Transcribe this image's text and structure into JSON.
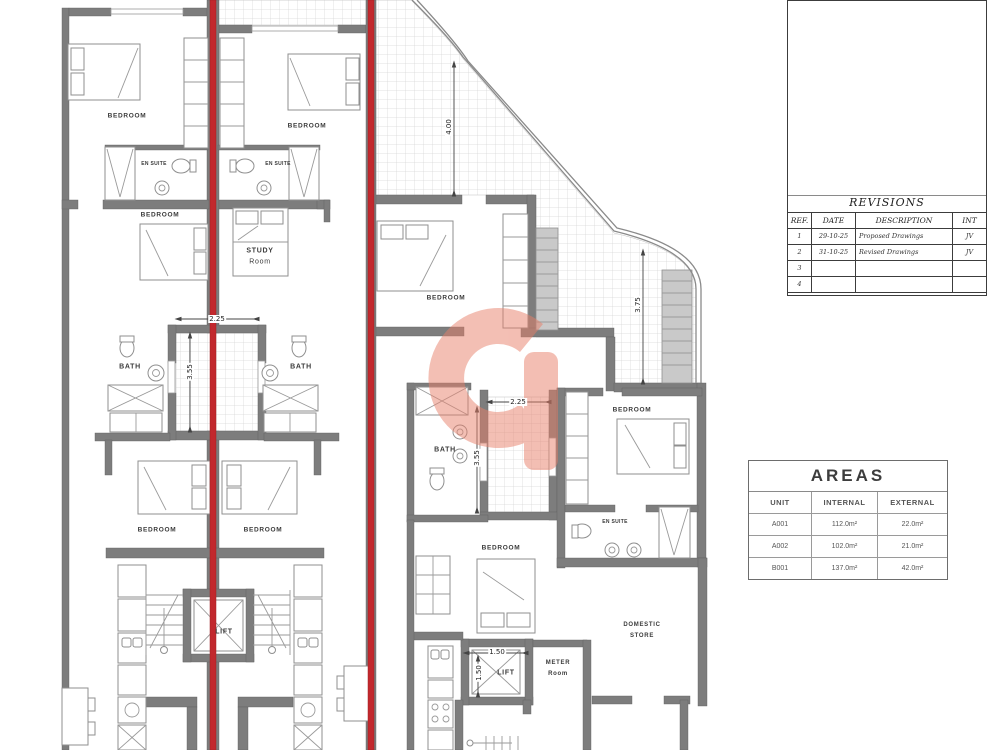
{
  "title_block": {
    "revisions": {
      "title": "REVISIONS",
      "headers": {
        "ref": "REF.",
        "date": "DATE",
        "description": "DESCRIPTION",
        "int": "INT"
      },
      "rows": [
        {
          "ref": "1",
          "date": "29-10-25",
          "description": "Proposed Drawings",
          "int": "JV"
        },
        {
          "ref": "2",
          "date": "31-10-25",
          "description": "Revised Drawings",
          "int": "JV"
        },
        {
          "ref": "3",
          "date": "",
          "description": "",
          "int": ""
        },
        {
          "ref": "4",
          "date": "",
          "description": "",
          "int": ""
        }
      ]
    }
  },
  "areas": {
    "title": "AREAS",
    "headers": {
      "unit": "UNIT",
      "internal": "INTERNAL",
      "external": "EXTERNAL"
    },
    "rows": [
      {
        "unit": "A001",
        "internal": "112.0m²",
        "external": "22.0m²"
      },
      {
        "unit": "A002",
        "internal": "102.0m²",
        "external": "21.0m²"
      },
      {
        "unit": "B001",
        "internal": "137.0m²",
        "external": "42.0m²"
      }
    ]
  },
  "labels": {
    "bedroom": "BEDROOM",
    "en_suite": "EN SUITE",
    "study_line1": "STUDY",
    "study_line2": "Room",
    "bath": "BATH",
    "lift": "LIFT",
    "meter_line1": "METER",
    "meter_line2": "Room",
    "domestic_line1": "DOMESTIC",
    "domestic_line2": "STORE"
  },
  "dimensions": {
    "terrace_front": "4.00",
    "terrace_side": "3.75",
    "shaft_a_width": "2.25",
    "shaft_a_height": "3.55",
    "shaft_b_width": "2.25",
    "shaft_b_height": "3.55",
    "lift_width": "1.50",
    "lift_depth": "1.50"
  },
  "colors": {
    "wall": "#7d7d7d",
    "section_line": "#c2282d",
    "watermark": "#e87f69"
  }
}
